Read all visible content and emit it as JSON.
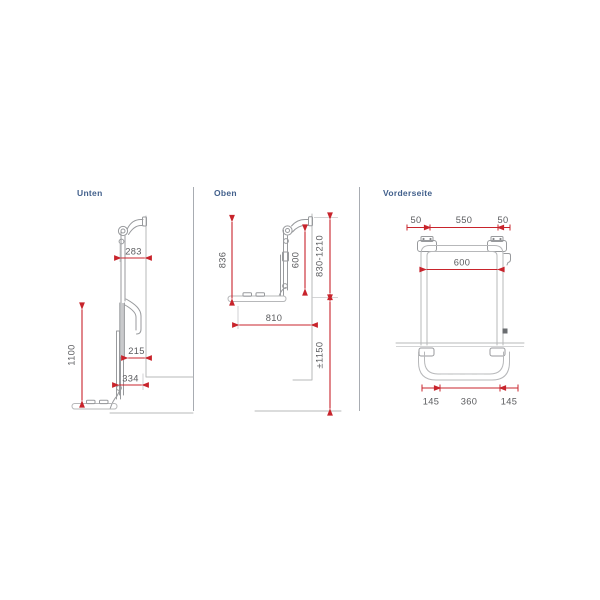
{
  "colors": {
    "background": "#ffffff",
    "label_navy": "#42608c",
    "dimension_red": "#c8242c",
    "dimension_text_gray": "#5a5b5e",
    "drawing_gray": "#b7b8ba"
  },
  "views": {
    "unten": {
      "label": "Unten",
      "dims": {
        "top_depth": "283",
        "height": "1100",
        "rail_depth": "215",
        "bottom_depth": "334"
      }
    },
    "oben": {
      "label": "Oben",
      "dims": {
        "rack_height": "836",
        "inner_height": "600",
        "mount_range": "830-1210",
        "platform_depth": "810",
        "ground_clearance": "±1150"
      }
    },
    "vorderseite": {
      "label": "Vorderseite",
      "dims": {
        "offset_left": "50",
        "bracket_span": "550",
        "offset_right": "50",
        "inner_width": "600",
        "bottom_left": "145",
        "bottom_center": "360",
        "bottom_right": "145"
      }
    }
  }
}
